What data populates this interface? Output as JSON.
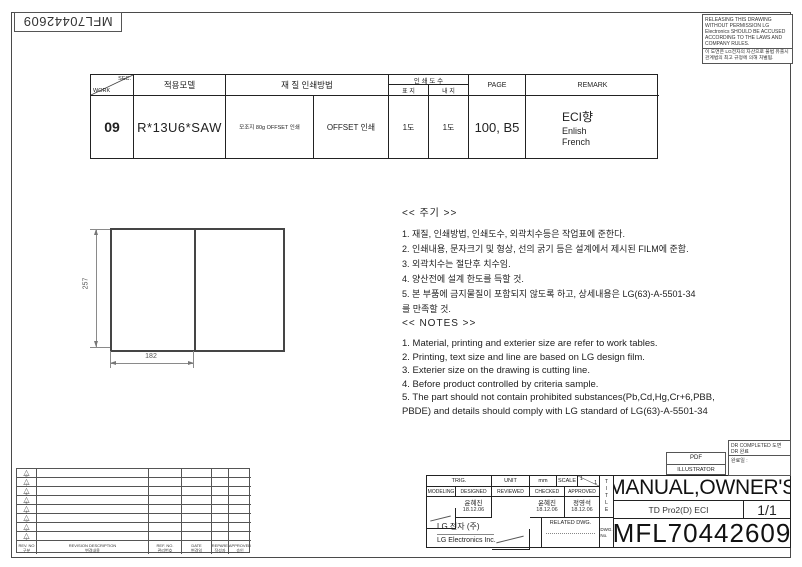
{
  "colors": {
    "paper": "#ffffff",
    "line": "#333333"
  },
  "stamp": {
    "number": "MFL70442609"
  },
  "warning": {
    "english": "RELEASING THIS DRAWING WITHOUT PERMISSION LG Electronics SHOULD BE ACCUSED ACCORDING TO THE LAWS AND COMPANY RULES.",
    "korean": "이 도면은 LG전자의 자산으로 불법 유출시 관계법의 최고 규정에 의해 처벌됨."
  },
  "spec_table": {
    "corner": {
      "top": "SEC.",
      "bottom": "WORK"
    },
    "headers": {
      "model": "적용모델",
      "material_method": "재  질  인쇄방법",
      "print_count": "인 쇄 도 수",
      "cover": "표 지",
      "inner": "내 지",
      "page": "PAGE",
      "remark": "REMARK"
    },
    "row": {
      "work": "09",
      "model": "R*13U6*SAW",
      "material": "모조지 80g OFFSET 인쇄",
      "method": "OFFSET 인쇄",
      "cover_count": "1도",
      "inner_count": "1도",
      "page": "100, B5",
      "remark_lines": [
        "ECI향",
        "Enlish",
        "French"
      ]
    }
  },
  "drawing": {
    "height_dim": "257",
    "width_dim": "182"
  },
  "notes_kr": {
    "title": "<< 주기 >>",
    "items": [
      "1. 재질, 인쇄방법, 인쇄도수, 외곽치수등은 작업표에 준한다.",
      "2. 인쇄내용, 문자크기 및 형상, 선의 굵기 등은 설계에서 제시된 FILM에 준함.",
      "3. 외곽치수는 절단후 치수임.",
      "4. 양산전에 설계 한도를 득할 것.",
      "5. 본 부품에 금지물질이 포함되지 않도록 하고, 상세내용은 LG(63)-A-5501-34\n    를 만족할 것."
    ]
  },
  "notes_en": {
    "title": "<< NOTES >>",
    "items": [
      "1. Material, printing and exterier size are refer to work tables.",
      "2. Printing, text size and line are based on LG design film.",
      "3. Exterier size on the drawing is cutting line.",
      "4. Before product controlled by criteria sample.",
      "5. The part should not contain prohibited substances(Pb,Cd,Hg,Cr+6,PBB,\n    PBDE) and details should comply with LG standard of LG(63)-A-5501-34"
    ]
  },
  "revision_table": {
    "markers": [
      "8",
      "7",
      "6",
      "5",
      "4",
      "3",
      "2",
      "1"
    ],
    "headers": {
      "rev_no": {
        "en": "REV. NO",
        "kr": "구분"
      },
      "description": {
        "en": "REVISION DESCRIPTION",
        "kr": "변경내용"
      },
      "ref_no": {
        "en": "REF. NO.",
        "kr": "관리번호"
      },
      "date": {
        "en": "DATE",
        "kr": "변경일"
      },
      "prepared": {
        "en": "PREPARED",
        "kr": "작성자"
      },
      "approved": {
        "en": "APPROVED",
        "kr": "승인"
      }
    }
  },
  "title_block": {
    "trig_label": "TRIG.",
    "unit_label": "UNIT",
    "unit_value": "mm",
    "scale_label": "SCALE",
    "scale_num": "1",
    "scale_den": "1",
    "col_modeling": "MODELING",
    "col_designed": "DESIGNED",
    "col_reviewed": "REVIEWED",
    "col_checked": "CHECKED",
    "col_approved": "APPROVED",
    "designed": {
      "name": "윤혜진",
      "date": "18.12.06"
    },
    "checked": {
      "name": "윤혜진",
      "date": "18.12.06"
    },
    "approved": {
      "name": "정영석",
      "date": "18.12.06"
    },
    "company_kr": "LG 전자   (주)",
    "company_en": "LG Electronics Inc.",
    "related_dwg_label": "RELATED DWG.",
    "title_vertical": "T\nI\nT\nL\nE",
    "dwg_no_label": "DWG.\nNo.",
    "title": "MANUAL,OWNER'S",
    "subtitle": "TD Pro2(D) ECI",
    "sheet": "1/1",
    "dwg_number": "MFL70442609",
    "pdf_box": {
      "line1": "PDF",
      "line2": "ILLUSTRATOR"
    },
    "dr_box": {
      "line1": "DR COMPLETED",
      "line2": "도면 DR 완료",
      "line3": "완료일 :"
    }
  }
}
